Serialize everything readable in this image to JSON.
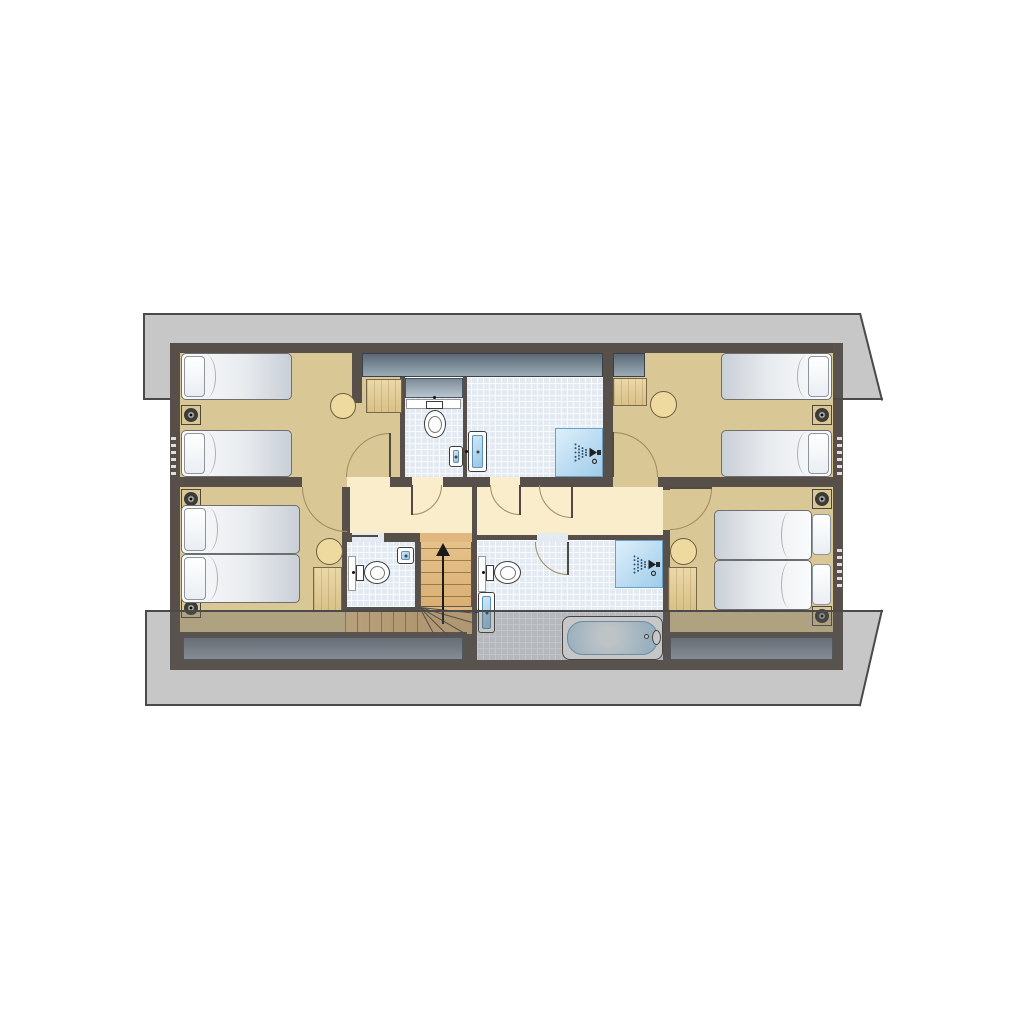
{
  "meta": {
    "kind": "architectural-floor-plan",
    "storey": "attic floor with sloping roof overhangs",
    "rooms": [
      "bedroom-top-left",
      "wc-top",
      "shower-room-top",
      "bedroom-top-right",
      "hallway",
      "bedroom-bottom-left",
      "wc-bottom",
      "staircase",
      "bathroom",
      "bedroom-bottom-right"
    ]
  },
  "palette": {
    "wall": "#57504a",
    "tan": "#d9c795",
    "hall": "#f9edcb",
    "tilebg": "#e4eaf2",
    "stairwood": "#e0b87f",
    "leaf": "#4f4a44",
    "ink": "#1b1b1b",
    "redge": "#4a4a4a",
    "roof": "rgba(92,92,92,0.34)",
    "glass_dark": "#5c6a76",
    "glass_light": "#9aabb6",
    "shower_blue": "#9fccea",
    "bed_white": "#fafbfc",
    "wood": "#ead8a8",
    "eaves_slate": "#6f7986",
    "door_arc": "#a08b60"
  },
  "elements": [
    {
      "name": "outer-wall",
      "t": "wall",
      "x": 170,
      "y": 343,
      "w": 673,
      "h": 327
    },
    {
      "name": "bedroom-top-left-floor",
      "t": "floor-tan",
      "x": 180,
      "y": 353,
      "w": 223,
      "h": 134
    },
    {
      "name": "wc-top-floor",
      "t": "tile",
      "x": 403,
      "y": 377,
      "w": 62,
      "h": 110
    },
    {
      "name": "shower-room-top-floor",
      "t": "tile",
      "x": 465,
      "y": 353,
      "w": 140,
      "h": 134
    },
    {
      "name": "bedroom-top-right-floor",
      "t": "floor-tan",
      "x": 605,
      "y": 353,
      "w": 228,
      "h": 134
    },
    {
      "name": "hallway-left-floor",
      "t": "floor-hall",
      "x": 342,
      "y": 485,
      "w": 130,
      "h": 50
    },
    {
      "name": "hallway-right-floor",
      "t": "floor-hall",
      "x": 477,
      "y": 485,
      "w": 190,
      "h": 50
    },
    {
      "name": "bedroom-bottom-left-floor",
      "t": "floor-tan",
      "x": 180,
      "y": 487,
      "w": 165,
      "h": 147
    },
    {
      "name": "wc-bottom-floor",
      "t": "tile",
      "x": 345,
      "y": 540,
      "w": 73,
      "h": 69
    },
    {
      "name": "stair-upper-flight",
      "t": "stairs-up",
      "x": 420,
      "y": 535,
      "w": 52,
      "h": 72
    },
    {
      "name": "stair-winder",
      "t": "box",
      "x": 420,
      "y": 607,
      "w": 52,
      "h": 27,
      "c": "stairwood"
    },
    {
      "name": "stair-lower-flight",
      "t": "stairs-run",
      "x": 345,
      "y": 612,
      "w": 75,
      "h": 21
    },
    {
      "name": "bathroom-floor",
      "t": "tile",
      "x": 477,
      "y": 540,
      "w": 190,
      "h": 120
    },
    {
      "name": "bedroom-bottom-right-floor",
      "t": "floor-tan",
      "x": 667,
      "y": 487,
      "w": 166,
      "h": 147
    },
    {
      "name": "eaves-band-left",
      "t": "eaves",
      "x": 183,
      "y": 637,
      "w": 280,
      "h": 23
    },
    {
      "name": "eaves-band-right",
      "t": "eaves",
      "x": 670,
      "y": 637,
      "w": 163,
      "h": 23
    },
    {
      "name": "rooflight-band-left",
      "t": "glass",
      "x": 362,
      "y": 353,
      "w": 241,
      "h": 24
    },
    {
      "name": "rooflight-band-right",
      "t": "glass",
      "x": 613,
      "y": 353,
      "w": 32,
      "h": 24
    },
    {
      "name": "rooflight-wc",
      "t": "glass-light",
      "x": 405,
      "y": 378,
      "w": 58,
      "h": 20
    },
    {
      "name": "wall-stub-top-left",
      "t": "wall",
      "x": 352,
      "y": 343,
      "w": 10,
      "h": 60
    },
    {
      "name": "wall-wc-top-west",
      "t": "wall",
      "x": 400,
      "y": 377,
      "w": 5,
      "h": 110
    },
    {
      "name": "wall-wc-top-east",
      "t": "wall",
      "x": 463,
      "y": 377,
      "w": 4,
      "h": 110
    },
    {
      "name": "wall-shower-top-east",
      "t": "wall",
      "x": 603,
      "y": 343,
      "w": 10,
      "h": 144
    },
    {
      "name": "wall-mid-horizontal",
      "t": "wall",
      "x": 180,
      "y": 477,
      "w": 653,
      "h": 10
    },
    {
      "name": "wall-hall-west",
      "t": "wall",
      "x": 342,
      "y": 485,
      "w": 8,
      "h": 57
    },
    {
      "name": "wall-wc-bottom-west",
      "t": "wall",
      "x": 342,
      "y": 535,
      "w": 5,
      "h": 77
    },
    {
      "name": "wall-wc-bottom-east",
      "t": "wall",
      "x": 415,
      "y": 533,
      "w": 5,
      "h": 79
    },
    {
      "name": "wall-stair-bath-divider",
      "t": "wall",
      "x": 472,
      "y": 485,
      "w": 5,
      "h": 175
    },
    {
      "name": "wall-hall-bottom",
      "t": "wall",
      "x": 342,
      "y": 533,
      "w": 135,
      "h": 9
    },
    {
      "name": "wall-wc-bottom-south",
      "t": "wall",
      "x": 342,
      "y": 607,
      "w": 78,
      "h": 5
    },
    {
      "name": "wall-bath-east",
      "t": "wall",
      "x": 663,
      "y": 485,
      "w": 7,
      "h": 175
    },
    {
      "name": "wall-south-left",
      "t": "wall",
      "x": 180,
      "y": 632,
      "w": 287,
      "h": 5
    },
    {
      "name": "wall-south-right",
      "t": "wall",
      "x": 667,
      "y": 632,
      "w": 166,
      "h": 5
    },
    {
      "name": "door-gap-bedroom-top-left",
      "t": "box",
      "x": 347,
      "y": 477,
      "w": 43,
      "h": 10,
      "c": "hall"
    },
    {
      "name": "door-gap-wc-top",
      "t": "box",
      "x": 412,
      "y": 477,
      "w": 31,
      "h": 10,
      "c": "hall"
    },
    {
      "name": "door-gap-shower-top",
      "t": "box",
      "x": 490,
      "y": 477,
      "w": 30,
      "h": 10,
      "c": "hall"
    },
    {
      "name": "door-gap-bedroom-top-right",
      "t": "box",
      "x": 613,
      "y": 477,
      "w": 45,
      "h": 10,
      "c": "tan"
    },
    {
      "name": "door-gap-bedroom-bottom-left",
      "t": "box",
      "x": 302,
      "y": 477,
      "w": 45,
      "h": 10,
      "c": "tan"
    },
    {
      "name": "door-gap-bedroom-bottom-right",
      "t": "box",
      "x": 663,
      "y": 490,
      "w": 7,
      "h": 40,
      "c": "tan"
    },
    {
      "name": "door-gap-bathroom",
      "t": "box",
      "x": 537,
      "y": 533,
      "w": 31,
      "h": 9,
      "c": "tilebg"
    },
    {
      "name": "door-gap-wc-bottom",
      "t": "box",
      "x": 352,
      "y": 533,
      "w": 32,
      "h": 9,
      "c": "tilebg"
    },
    {
      "name": "sliding-door-wc-bottom",
      "t": "box",
      "x": 352,
      "y": 535,
      "w": 26,
      "h": 2,
      "c": "leaf"
    },
    {
      "name": "door-gap-stairs",
      "t": "box",
      "x": 420,
      "y": 533,
      "w": 52,
      "h": 9,
      "c": "stairwood"
    },
    {
      "name": "door-arc-bedroom-top-left",
      "t": "arc",
      "q": "nw",
      "x": 346,
      "y": 433,
      "w": 88,
      "h": 88
    },
    {
      "name": "door-leaf-bedroom-top-left",
      "t": "leaf",
      "x": 389,
      "y": 433,
      "w": 2,
      "h": 44
    },
    {
      "name": "door-arc-wc-top",
      "t": "arc",
      "q": "se",
      "x": 382,
      "y": 455,
      "w": 60,
      "h": 60
    },
    {
      "name": "door-leaf-wc-top",
      "t": "leaf",
      "x": 411,
      "y": 485,
      "w": 2,
      "h": 30
    },
    {
      "name": "door-arc-shower-top",
      "t": "arc",
      "q": "sw",
      "x": 490,
      "y": 455,
      "w": 60,
      "h": 60
    },
    {
      "name": "door-leaf-shower-top",
      "t": "leaf",
      "x": 519,
      "y": 485,
      "w": 2,
      "h": 30
    },
    {
      "name": "door-arc-hallway",
      "t": "arc",
      "q": "sw",
      "x": 539,
      "y": 452,
      "w": 66,
      "h": 66
    },
    {
      "name": "door-leaf-hallway",
      "t": "leaf",
      "x": 571,
      "y": 485,
      "w": 2,
      "h": 33
    },
    {
      "name": "door-arc-bedroom-top-right",
      "t": "arc",
      "q": "ne",
      "x": 568,
      "y": 432,
      "w": 90,
      "h": 90
    },
    {
      "name": "door-leaf-bedroom-top-right",
      "t": "leaf",
      "x": 612,
      "y": 432,
      "w": 2,
      "h": 45
    },
    {
      "name": "door-arc-bedroom-bottom-left",
      "t": "arc",
      "q": "sw",
      "x": 302,
      "y": 442,
      "w": 90,
      "h": 90
    },
    {
      "name": "door-arc-bedroom-bottom-right",
      "t": "arc",
      "q": "se",
      "x": 628,
      "y": 446,
      "w": 84,
      "h": 84
    },
    {
      "name": "door-leaf-bedroom-bottom-right",
      "t": "leaf",
      "x": 670,
      "y": 487,
      "w": 42,
      "h": 2
    },
    {
      "name": "door-arc-bathroom",
      "t": "arc",
      "q": "sw",
      "x": 535,
      "y": 509,
      "w": 66,
      "h": 66
    },
    {
      "name": "door-leaf-bathroom",
      "t": "leaf",
      "x": 567,
      "y": 542,
      "w": 2,
      "h": 33
    },
    {
      "name": "bed-single",
      "t": "bed",
      "x": 181,
      "y": 353,
      "w": 111,
      "h": 47
    },
    {
      "name": "pillow",
      "t": "pillow",
      "x": 184,
      "y": 356,
      "w": 21,
      "h": 41
    },
    {
      "name": "bed-single",
      "t": "bed",
      "x": 181,
      "y": 430,
      "w": 111,
      "h": 47
    },
    {
      "name": "pillow",
      "t": "pillow",
      "x": 184,
      "y": 433,
      "w": 21,
      "h": 41
    },
    {
      "name": "downlight",
      "t": "downlight",
      "x": 181,
      "y": 405,
      "w": 20,
      "h": 20
    },
    {
      "name": "side-table-round",
      "t": "table",
      "x": 330,
      "y": 393,
      "w": 26,
      "h": 26
    },
    {
      "name": "closet",
      "t": "wood",
      "x": 366,
      "y": 379,
      "w": 36,
      "h": 34
    },
    {
      "name": "wc-shelf",
      "t": "shelf",
      "x": 406,
      "y": 399,
      "w": 55,
      "h": 10
    },
    {
      "name": "toilet-cistern",
      "t": "cistern",
      "x": 426,
      "y": 401,
      "w": 17,
      "h": 8
    },
    {
      "name": "toilet-bowl",
      "t": "bowl",
      "x": 424,
      "y": 410,
      "w": 22,
      "h": 28
    },
    {
      "name": "toilet-bowl-inner",
      "t": "bowl-inner",
      "x": 428,
      "y": 416,
      "w": 14,
      "h": 17
    },
    {
      "name": "toilet-dot",
      "t": "dot",
      "x": 433,
      "y": 396,
      "w": 3,
      "h": 3
    },
    {
      "name": "hand-basin",
      "t": "basin",
      "x": 449,
      "y": 446,
      "w": 14,
      "h": 21
    },
    {
      "name": "washbasin",
      "t": "basin",
      "x": 468,
      "y": 431,
      "w": 19,
      "h": 41
    },
    {
      "name": "faucet-dot",
      "t": "dot",
      "x": 465,
      "y": 450,
      "w": 3,
      "h": 3
    },
    {
      "name": "shower-tray",
      "t": "shower",
      "x": 555,
      "y": 428,
      "w": 48,
      "h": 49
    },
    {
      "name": "shower-head-icon",
      "t": "svg",
      "icon": "spray",
      "x": 557,
      "y": 439,
      "w": 44,
      "h": 27
    },
    {
      "name": "closet",
      "t": "wood",
      "x": 613,
      "y": 378,
      "w": 34,
      "h": 28
    },
    {
      "name": "side-table-round",
      "t": "table",
      "x": 650,
      "y": 391,
      "w": 27,
      "h": 27
    },
    {
      "name": "bed-single",
      "t": "bed",
      "cls": "flip",
      "x": 721,
      "y": 353,
      "w": 111,
      "h": 47
    },
    {
      "name": "pillow",
      "t": "pillow",
      "x": 808,
      "y": 356,
      "w": 21,
      "h": 41
    },
    {
      "name": "bed-single",
      "t": "bed",
      "cls": "flip",
      "x": 721,
      "y": 430,
      "w": 111,
      "h": 47
    },
    {
      "name": "pillow",
      "t": "pillow",
      "x": 808,
      "y": 433,
      "w": 21,
      "h": 41
    },
    {
      "name": "downlight",
      "t": "downlight",
      "x": 812,
      "y": 405,
      "w": 20,
      "h": 20
    },
    {
      "name": "downlight",
      "t": "downlight",
      "x": 181,
      "y": 489,
      "w": 20,
      "h": 20
    },
    {
      "name": "downlight",
      "t": "downlight",
      "x": 181,
      "y": 598,
      "w": 20,
      "h": 20
    },
    {
      "name": "bed-double-half",
      "t": "bed",
      "x": 181,
      "y": 505,
      "w": 119,
      "h": 49
    },
    {
      "name": "bed-double-half",
      "t": "bed",
      "x": 181,
      "y": 554,
      "w": 119,
      "h": 49
    },
    {
      "name": "pillow",
      "t": "pillow",
      "x": 184,
      "y": 508,
      "w": 22,
      "h": 43
    },
    {
      "name": "pillow",
      "t": "pillow",
      "x": 184,
      "y": 557,
      "w": 22,
      "h": 43
    },
    {
      "name": "side-table-round",
      "t": "table",
      "x": 316,
      "y": 538,
      "w": 27,
      "h": 27
    },
    {
      "name": "wardrobe",
      "t": "wood",
      "x": 313,
      "y": 567,
      "w": 29,
      "h": 45
    },
    {
      "name": "wc-shelf",
      "t": "shelf",
      "x": 348,
      "y": 556,
      "w": 8,
      "h": 35
    },
    {
      "name": "toilet-cistern",
      "t": "cistern",
      "x": 356,
      "y": 565,
      "w": 8,
      "h": 16
    },
    {
      "name": "toilet-bowl",
      "t": "bowl",
      "x": 364,
      "y": 561,
      "w": 26,
      "h": 23
    },
    {
      "name": "toilet-bowl-inner",
      "t": "bowl-inner",
      "x": 370,
      "y": 566,
      "w": 15,
      "h": 14
    },
    {
      "name": "toilet-dot",
      "t": "dot",
      "x": 352,
      "y": 571,
      "w": 3,
      "h": 3
    },
    {
      "name": "hand-basin",
      "t": "basin",
      "x": 397,
      "y": 547,
      "w": 17,
      "h": 17
    },
    {
      "name": "stair-winder-line",
      "t": "fan",
      "x": 420,
      "y": 607,
      "l": 52,
      "a": 6
    },
    {
      "name": "stair-winder-line",
      "t": "fan",
      "x": 420,
      "y": 607,
      "l": 54,
      "a": 16
    },
    {
      "name": "stair-winder-line",
      "t": "fan",
      "x": 420,
      "y": 607,
      "l": 52,
      "a": 30
    },
    {
      "name": "stair-winder-line",
      "t": "fan",
      "x": 420,
      "y": 607,
      "l": 40,
      "a": 45
    },
    {
      "name": "stair-winder-line",
      "t": "fan",
      "x": 420,
      "y": 607,
      "l": 30,
      "a": 62
    },
    {
      "name": "stair-arrow-shaft",
      "t": "box",
      "x": 442,
      "y": 556,
      "w": 2,
      "h": 68,
      "c": "ink"
    },
    {
      "name": "stair-arrow-head",
      "t": "tri-up",
      "x": 436,
      "y": 543
    },
    {
      "name": "wc-shelf",
      "t": "shelf",
      "x": 478,
      "y": 556,
      "w": 8,
      "h": 36
    },
    {
      "name": "toilet-cistern",
      "t": "cistern",
      "x": 486,
      "y": 565,
      "w": 8,
      "h": 16
    },
    {
      "name": "toilet-bowl",
      "t": "bowl",
      "x": 494,
      "y": 561,
      "w": 27,
      "h": 23
    },
    {
      "name": "toilet-bowl-inner",
      "t": "bowl-inner",
      "x": 500,
      "y": 566,
      "w": 16,
      "h": 14
    },
    {
      "name": "toilet-dot",
      "t": "dot",
      "x": 482,
      "y": 571,
      "w": 3,
      "h": 3
    },
    {
      "name": "washbasin",
      "t": "basin",
      "x": 478,
      "y": 592,
      "w": 17,
      "h": 41
    },
    {
      "name": "faucet-dot",
      "t": "dot",
      "x": 475,
      "y": 610,
      "w": 3,
      "h": 3
    },
    {
      "name": "shower-tray",
      "t": "shower",
      "x": 615,
      "y": 540,
      "w": 48,
      "h": 48
    },
    {
      "name": "shower-head-icon",
      "t": "svg",
      "icon": "spray",
      "x": 616,
      "y": 551,
      "w": 44,
      "h": 27
    },
    {
      "name": "bathtub",
      "t": "tub",
      "x": 562,
      "y": 616,
      "w": 101,
      "h": 44
    },
    {
      "name": "bath-tap",
      "t": "bowl",
      "x": 652,
      "y": 630,
      "w": 9,
      "h": 15
    },
    {
      "name": "bath-tap-ring",
      "t": "ring",
      "x": 644,
      "y": 634,
      "w": 5,
      "h": 5
    },
    {
      "name": "side-table-round",
      "t": "table",
      "x": 670,
      "y": 538,
      "w": 27,
      "h": 27
    },
    {
      "name": "wardrobe",
      "t": "wood",
      "x": 668,
      "y": 567,
      "w": 29,
      "h": 44
    },
    {
      "name": "bed-double-half",
      "t": "bed",
      "cls": "flip",
      "x": 714,
      "y": 510,
      "w": 98,
      "h": 50
    },
    {
      "name": "bed-double-half",
      "t": "bed",
      "cls": "flip",
      "x": 714,
      "y": 560,
      "w": 98,
      "h": 50
    },
    {
      "name": "pillow",
      "t": "pillow",
      "x": 812,
      "y": 514,
      "w": 19,
      "h": 41
    },
    {
      "name": "pillow",
      "t": "pillow",
      "x": 812,
      "y": 564,
      "w": 19,
      "h": 41
    },
    {
      "name": "downlight",
      "t": "downlight",
      "x": 812,
      "y": 489,
      "w": 20,
      "h": 20
    },
    {
      "name": "downlight",
      "t": "downlight",
      "x": 812,
      "y": 606,
      "w": 20,
      "h": 20
    },
    {
      "name": "wall-vent",
      "t": "vent",
      "x": 171,
      "y": 437,
      "w": 5,
      "h": 42
    },
    {
      "name": "wall-vent",
      "t": "vent",
      "x": 837,
      "y": 437,
      "w": 5,
      "h": 42
    },
    {
      "name": "wall-vent",
      "t": "vent",
      "x": 837,
      "y": 549,
      "w": 5,
      "h": 42
    },
    {
      "name": "roof-overhang-top",
      "t": "roof-top",
      "x": 143,
      "y": 313,
      "w": 740,
      "h": 87,
      "z": 40
    },
    {
      "name": "roof-overhang-bottom",
      "t": "roof-bot",
      "x": 145,
      "y": 610,
      "w": 738,
      "h": 96,
      "z": 40
    },
    {
      "name": "roof-edge",
      "t": "box",
      "x": 143,
      "y": 313,
      "w": 718,
      "h": 2,
      "c": "redge",
      "z": 41
    },
    {
      "name": "roof-edge",
      "t": "box",
      "x": 143,
      "y": 313,
      "w": 2,
      "h": 87,
      "c": "redge",
      "z": 41
    },
    {
      "name": "roof-edge",
      "t": "box",
      "x": 143,
      "y": 398,
      "w": 28,
      "h": 2,
      "c": "redge",
      "z": 41
    },
    {
      "name": "roof-edge",
      "t": "box",
      "x": 833,
      "y": 398,
      "w": 50,
      "h": 2,
      "c": "redge",
      "z": 41
    },
    {
      "name": "roof-edge-slant",
      "t": "redge-line",
      "x": 861,
      "y": 313,
      "l": 90,
      "a": 75.8,
      "z": 41
    },
    {
      "name": "roof-edge",
      "t": "box",
      "x": 145,
      "y": 610,
      "w": 738,
      "h": 2,
      "c": "redge",
      "z": 41
    },
    {
      "name": "roof-edge",
      "t": "box",
      "x": 145,
      "y": 610,
      "w": 2,
      "h": 96,
      "c": "redge",
      "z": 41
    },
    {
      "name": "roof-edge",
      "t": "box",
      "x": 145,
      "y": 704,
      "w": 716,
      "h": 2,
      "c": "redge",
      "z": 41
    },
    {
      "name": "roof-edge-slant",
      "t": "redge-line",
      "x": 883,
      "y": 610,
      "l": 99,
      "a": 103,
      "z": 41
    }
  ]
}
